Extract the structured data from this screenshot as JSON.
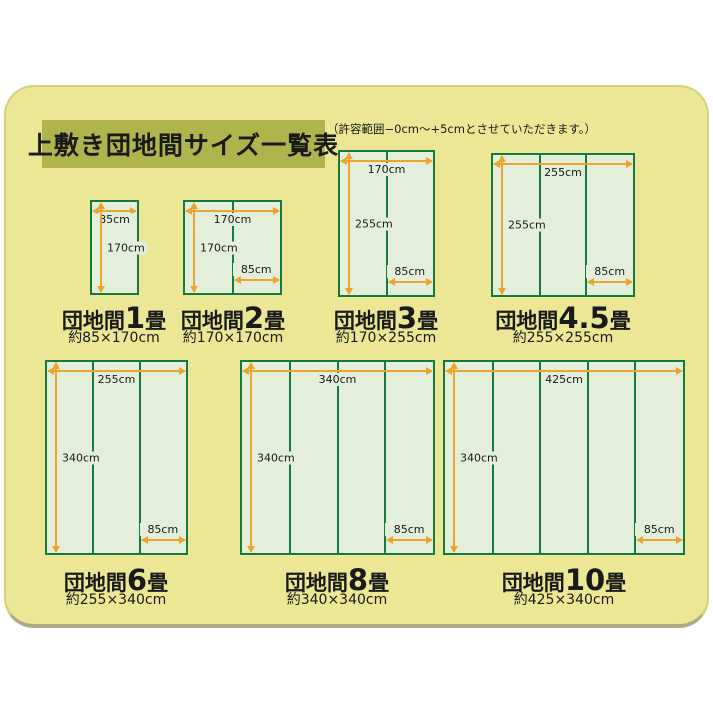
{
  "colors": {
    "card_bg": "#ebe795",
    "title_bg": "#b0b44c",
    "mat_fill": "#e3efdb",
    "mat_border": "#157b3d",
    "arrow": "#eda42d",
    "text": "#1a1a1a"
  },
  "header": {
    "title": "上敷き団地間サイズ一覧表",
    "note": "（許容範囲−0cm〜+5cmとさせていただきます。）"
  },
  "mats": [
    {
      "label_prefix": "団地間",
      "label_num": "1",
      "label_suffix": "畳",
      "size_caption": "約85×170cm",
      "panels": 1,
      "width_cm": 85,
      "height_cm": 170,
      "top_label": "85cm",
      "left_label": "170cm",
      "bottom_label": ""
    },
    {
      "label_prefix": "団地間",
      "label_num": "2",
      "label_suffix": "畳",
      "size_caption": "約170×170cm",
      "panels": 2,
      "width_cm": 170,
      "height_cm": 170,
      "top_label": "170cm",
      "left_label": "170cm",
      "bottom_label": "85cm"
    },
    {
      "label_prefix": "団地間",
      "label_num": "3",
      "label_suffix": "畳",
      "size_caption": "約170×255cm",
      "panels": 2,
      "width_cm": 170,
      "height_cm": 255,
      "top_label": "170cm",
      "left_label": "255cm",
      "bottom_label": "85cm"
    },
    {
      "label_prefix": "団地間",
      "label_num": "4.5",
      "label_suffix": "畳",
      "size_caption": "約255×255cm",
      "panels": 3,
      "width_cm": 255,
      "height_cm": 255,
      "top_label": "255cm",
      "left_label": "255cm",
      "bottom_label": "85cm"
    },
    {
      "label_prefix": "団地間",
      "label_num": "6",
      "label_suffix": "畳",
      "size_caption": "約255×340cm",
      "panels": 3,
      "width_cm": 255,
      "height_cm": 340,
      "top_label": "255cm",
      "left_label": "340cm",
      "bottom_label": "85cm"
    },
    {
      "label_prefix": "団地間",
      "label_num": "8",
      "label_suffix": "畳",
      "size_caption": "約340×340cm",
      "panels": 4,
      "width_cm": 340,
      "height_cm": 340,
      "top_label": "340cm",
      "left_label": "340cm",
      "bottom_label": "85cm"
    },
    {
      "label_prefix": "団地間",
      "label_num": "10",
      "label_suffix": "畳",
      "size_caption": "約425×340cm",
      "panels": 5,
      "width_cm": 425,
      "height_cm": 340,
      "top_label": "425cm",
      "left_label": "340cm",
      "bottom_label": "85cm"
    }
  ]
}
